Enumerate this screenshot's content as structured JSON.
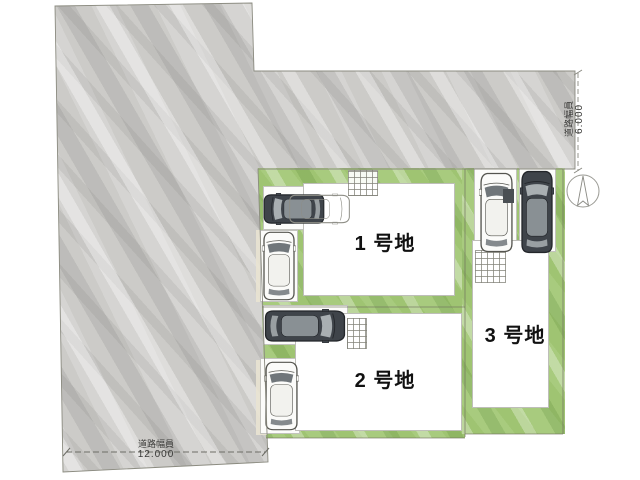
{
  "plan": {
    "lots": [
      {
        "id": "lot-1",
        "label": "1 号地"
      },
      {
        "id": "lot-2",
        "label": "2 号地"
      },
      {
        "id": "lot-3",
        "label": "3 号地"
      }
    ],
    "dimensions": {
      "bottom_road": {
        "label": "道路幅員",
        "value": "12.000"
      },
      "right_road": {
        "label": "道路幅員",
        "value": "6.000"
      }
    },
    "icons": {
      "compass": "north-arrow-icon",
      "cars": [
        "dark-car-top-icon",
        "white-car-top-icon",
        "ghost-car-outline-icon"
      ]
    },
    "colors": {
      "road_gray": "#cccbc8",
      "lot_green": "#a8cb7e",
      "building_white": "#ffffff",
      "car_dark": "#3f444a",
      "boundary_line": "#70705f"
    }
  }
}
